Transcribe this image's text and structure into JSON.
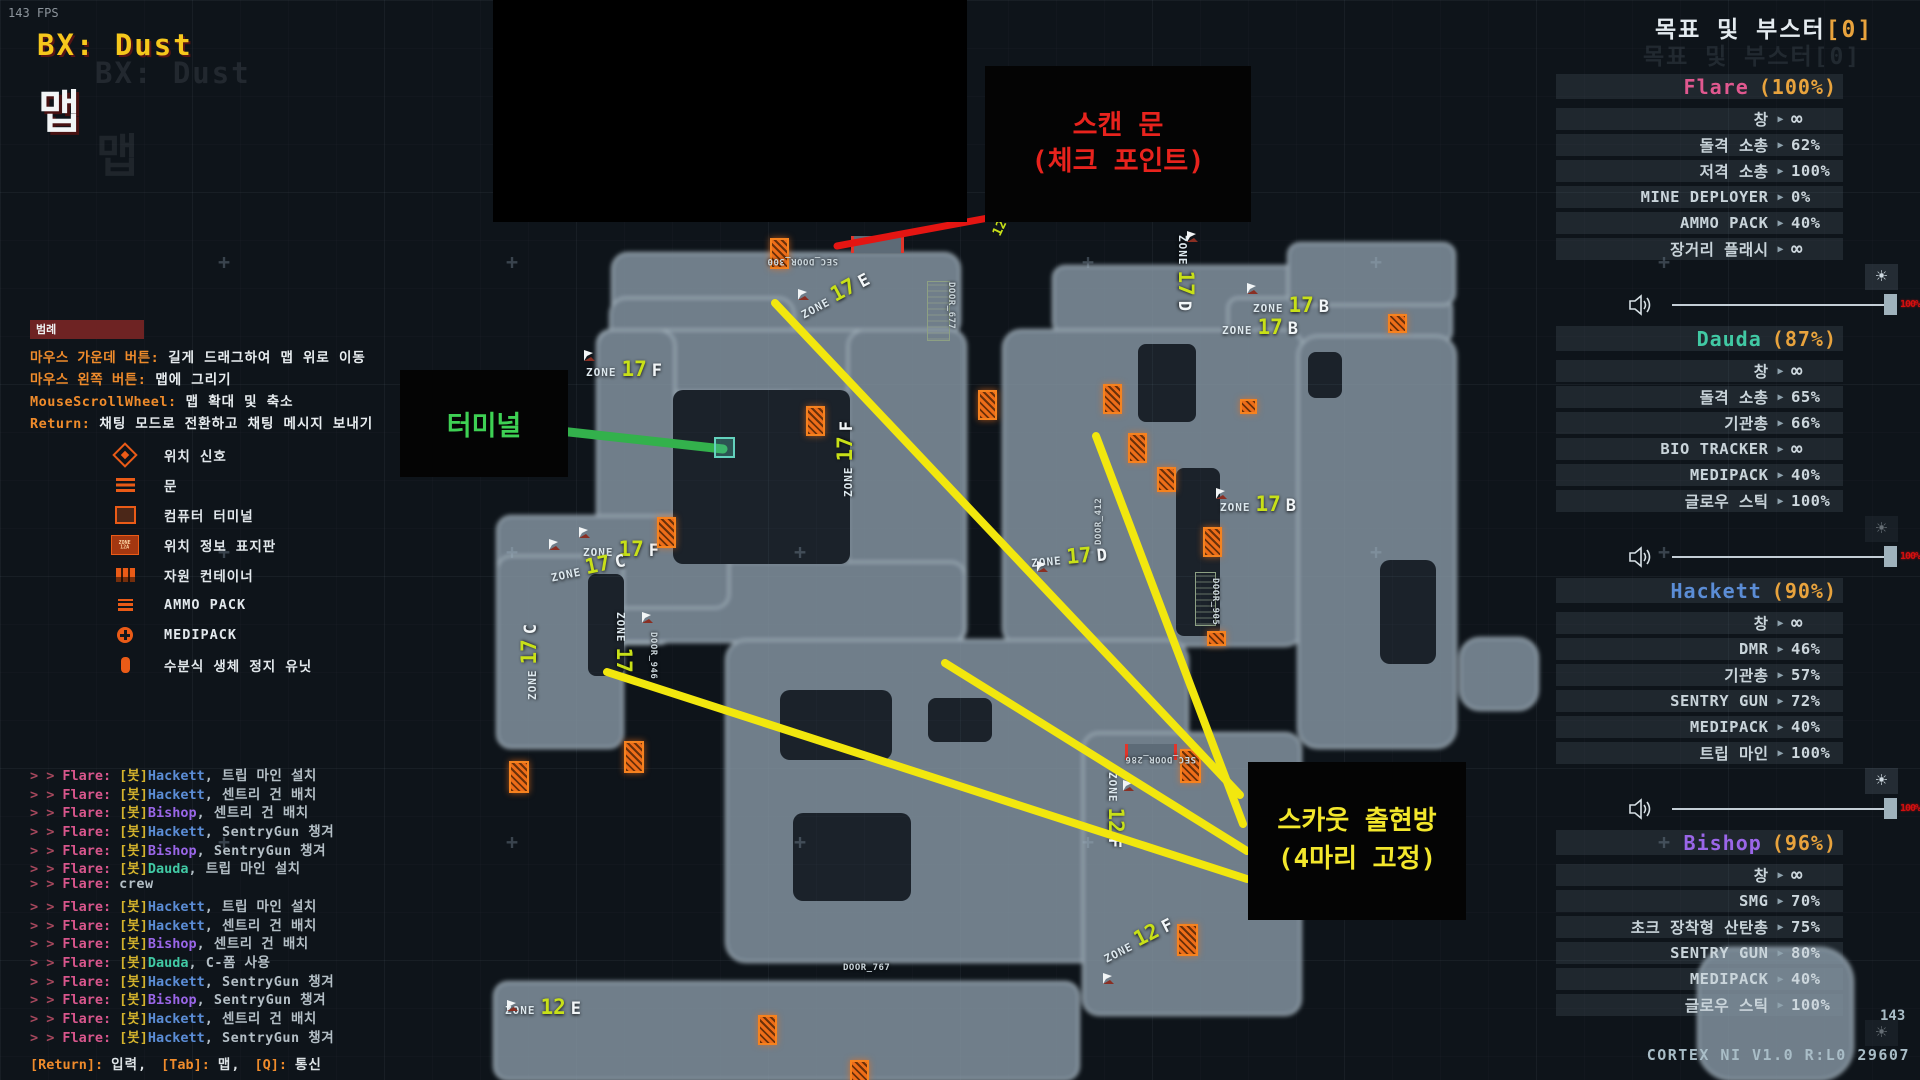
{
  "hud": {
    "fps": "143 FPS",
    "expedition": "BX: Dust",
    "map_label": "맵"
  },
  "objectives": {
    "title": "목표 및 부스터",
    "counter": "[0]"
  },
  "ui": {
    "arrow": "▶",
    "brightness": "☀",
    "volume_value": "100%",
    "infinity": "∞",
    "zone_word": "ZONE",
    "chat_prefix": "> >",
    "colors": {
      "accent_orange": "#e8a33d",
      "zone_number": "#c8e018",
      "door_orange": "#ee6d19",
      "line_yellow": "#f2e70e",
      "line_red": "#e41512",
      "line_green": "#33b14c"
    }
  },
  "players": [
    {
      "name": "Flare",
      "pct": "(100%)",
      "color": "#e0588f",
      "slider": true,
      "brightness_dim": false,
      "items": [
        {
          "label": "창",
          "value": "∞"
        },
        {
          "label": "돌격 소총",
          "value": "62%"
        },
        {
          "label": "저격 소총",
          "value": "100%"
        },
        {
          "label": "MINE DEPLOYER",
          "value": "0%"
        },
        {
          "label": "AMMO PACK",
          "value": "40%"
        },
        {
          "label": "장거리 플래시",
          "value": "∞"
        }
      ]
    },
    {
      "name": "Dauda",
      "pct": "(87%)",
      "color": "#41c9a4",
      "slider": true,
      "brightness_dim": true,
      "items": [
        {
          "label": "창",
          "value": "∞"
        },
        {
          "label": "돌격 소총",
          "value": "65%"
        },
        {
          "label": "기관총",
          "value": "66%"
        },
        {
          "label": "BIO TRACKER",
          "value": "∞"
        },
        {
          "label": "MEDIPACK",
          "value": "40%"
        },
        {
          "label": "글로우 스틱",
          "value": "100%"
        }
      ]
    },
    {
      "name": "Hackett",
      "pct": "(90%)",
      "color": "#5b8dd6",
      "slider": true,
      "brightness_dim": false,
      "items": [
        {
          "label": "창",
          "value": "∞"
        },
        {
          "label": "DMR",
          "value": "46%"
        },
        {
          "label": "기관총",
          "value": "57%"
        },
        {
          "label": "SENTRY GUN",
          "value": "72%"
        },
        {
          "label": "MEDIPACK",
          "value": "40%"
        },
        {
          "label": "트립 마인",
          "value": "100%"
        }
      ]
    },
    {
      "name": "Bishop",
      "pct": "(96%)",
      "color": "#9a66e8",
      "slider": false,
      "brightness_dim": true,
      "items": [
        {
          "label": "창",
          "value": "∞"
        },
        {
          "label": "SMG",
          "value": "70%"
        },
        {
          "label": "초크 장착형 산탄총",
          "value": "75%"
        },
        {
          "label": "SENTRY GUN",
          "value": "80%"
        },
        {
          "label": "MEDIPACK",
          "value": "40%"
        },
        {
          "label": "글로우 스틱",
          "value": "100%"
        }
      ]
    }
  ],
  "legend": {
    "title": "범례",
    "bindings": [
      {
        "key": "마우스 가운데 버튼:",
        "desc": "길게 드래그하여 맵 위로 이동"
      },
      {
        "key": "마우스 왼쪽 버튼:",
        "desc": "맵에 그리기"
      },
      {
        "key": "MouseScrollWheel:",
        "desc": "맵 확대 및 축소"
      },
      {
        "key": "Return:",
        "desc": "채팅 모드로 전환하고 채팅 메시지 보내기"
      }
    ],
    "items": [
      {
        "icon": "signal",
        "label": "위치 신호"
      },
      {
        "icon": "door",
        "label": "문"
      },
      {
        "icon": "terminal",
        "label": "컴퓨터 터미널"
      },
      {
        "icon": "zonesign",
        "label": "위치 정보 표지판",
        "sign_text": "ZONE\n12A"
      },
      {
        "icon": "container",
        "label": "자원 컨테이너"
      },
      {
        "icon": "ammo",
        "label": "AMMO PACK"
      },
      {
        "icon": "medi",
        "label": "MEDIPACK"
      },
      {
        "icon": "hsu",
        "label": "수분식 생체 정지 유닛"
      }
    ]
  },
  "chat": {
    "lines": [
      {
        "from": "Flare:",
        "bot": "[봇]",
        "who": "Hackett",
        "msg": ", 트립 마인 설치"
      },
      {
        "from": "Flare:",
        "bot": "[봇]",
        "who": "Hackett",
        "msg": ", 센트리 건 배치"
      },
      {
        "from": "Flare:",
        "bot": "[봇]",
        "who": "Bishop",
        "msg": ", 센트리 건 배치"
      },
      {
        "from": "Flare:",
        "bot": "[봇]",
        "who": "Hackett",
        "msg": ", SentryGun 챙겨"
      },
      {
        "from": "Flare:",
        "bot": "[봇]",
        "who": "Bishop",
        "msg": ", SentryGun 챙겨"
      },
      {
        "from": "Flare:",
        "bot": "[봇]",
        "who": "Dauda",
        "msg": ", 트립 마인 설치"
      },
      {
        "from": "Flare:",
        "bot": "",
        "who": "",
        "msg": "crew"
      },
      {
        "from": "Flare:",
        "bot": "[봇]",
        "who": "Hackett",
        "msg": ", 트립 마인 설치"
      },
      {
        "from": "Flare:",
        "bot": "[봇]",
        "who": "Hackett",
        "msg": ", 센트리 건 배치"
      },
      {
        "from": "Flare:",
        "bot": "[봇]",
        "who": "Bishop",
        "msg": ", 센트리 건 배치"
      },
      {
        "from": "Flare:",
        "bot": "[봇]",
        "who": "Dauda",
        "msg": ", C-폼 사용"
      },
      {
        "from": "Flare:",
        "bot": "[봇]",
        "who": "Hackett",
        "msg": ", SentryGun 챙겨"
      },
      {
        "from": "Flare:",
        "bot": "[봇]",
        "who": "Bishop",
        "msg": ", SentryGun 챙겨"
      },
      {
        "from": "Flare:",
        "bot": "[봇]",
        "who": "Hackett",
        "msg": ", 센트리 건 배치"
      },
      {
        "from": "Flare:",
        "bot": "[봇]",
        "who": "Hackett",
        "msg": ", SentryGun 챙겨"
      }
    ],
    "footer_segments": [
      {
        "key": "[Return]:",
        "text": "입력,"
      },
      {
        "key": "[Tab]:",
        "text": "맵,"
      },
      {
        "key": "[Q]:",
        "text": "통신"
      }
    ]
  },
  "map": {
    "zones": [
      {
        "z": "17E",
        "x": 795,
        "y": 302,
        "rot": -28
      },
      {
        "z": "17D",
        "x": 1198,
        "y": 235,
        "rot": 90
      },
      {
        "z": "17F",
        "x": 586,
        "y": 357,
        "rot": 0
      },
      {
        "z": "17F",
        "x": 833,
        "y": 497,
        "rot": -90
      },
      {
        "z": "17F",
        "x": 583,
        "y": 537,
        "rot": 0
      },
      {
        "z": "17C",
        "x": 548,
        "y": 563,
        "rot": -12
      },
      {
        "z": "17C",
        "x": 517,
        "y": 700,
        "rot": -90
      },
      {
        "z": "17",
        "x": 636,
        "y": 612,
        "rot": 90
      },
      {
        "z": "17D",
        "x": 1030,
        "y": 548,
        "rot": -5
      },
      {
        "z": "17B",
        "x": 1253,
        "y": 293,
        "rot": 0
      },
      {
        "z": "17B",
        "x": 1222,
        "y": 315,
        "rot": 0
      },
      {
        "z": "17B",
        "x": 1220,
        "y": 492,
        "rot": 0
      },
      {
        "z": "12F",
        "x": 1128,
        "y": 772,
        "rot": 90
      },
      {
        "z": "12F",
        "x": 1098,
        "y": 946,
        "rot": -27
      },
      {
        "z": "12E",
        "x": 505,
        "y": 995,
        "rot": 0
      }
    ],
    "door_labels": [
      {
        "text": "SEC_DOOR_300",
        "x": 838,
        "y": 266,
        "rot": 180
      },
      {
        "text": "DOOR_677",
        "x": 956,
        "y": 282,
        "rot": 90
      },
      {
        "text": "DOOR_412",
        "x": 1094,
        "y": 545,
        "rot": -90
      },
      {
        "text": "DOOR_905",
        "x": 1220,
        "y": 578,
        "rot": 90
      },
      {
        "text": "DOOR_946",
        "x": 658,
        "y": 632,
        "rot": 90
      },
      {
        "text": "SEC_DOOR_286",
        "x": 1196,
        "y": 764,
        "rot": 180
      },
      {
        "text": "DOOR_767",
        "x": 843,
        "y": 963,
        "rot": 0
      }
    ],
    "misc_labels": [
      {
        "text": "12",
        "x": 990,
        "y": 232,
        "rot": -64
      }
    ],
    "doors": [
      [
        770,
        238,
        15,
        27
      ],
      [
        806,
        406,
        15,
        26
      ],
      [
        978,
        390,
        15,
        26
      ],
      [
        1103,
        384,
        15,
        26
      ],
      [
        1128,
        433,
        15,
        26
      ],
      [
        1240,
        399,
        13,
        11
      ],
      [
        1388,
        314,
        15,
        15
      ],
      [
        1157,
        467,
        15,
        21
      ],
      [
        1203,
        527,
        15,
        26
      ],
      [
        1207,
        631,
        15,
        11
      ],
      [
        657,
        517,
        15,
        27
      ],
      [
        624,
        741,
        16,
        28
      ],
      [
        509,
        761,
        16,
        28
      ],
      [
        1180,
        749,
        17,
        30
      ],
      [
        1177,
        924,
        17,
        28
      ],
      [
        758,
        1015,
        15,
        26
      ],
      [
        850,
        1060,
        15,
        19
      ]
    ],
    "gates": [
      [
        927,
        281,
        21,
        58
      ],
      [
        1195,
        572,
        19,
        52
      ]
    ],
    "scan_doors": [
      [
        851,
        236,
        47,
        17
      ],
      [
        1125,
        744,
        46,
        16
      ]
    ],
    "flags": [
      [
        797,
        286
      ],
      [
        1186,
        228
      ],
      [
        583,
        347
      ],
      [
        578,
        524
      ],
      [
        548,
        536
      ],
      [
        641,
        609
      ],
      [
        1246,
        280
      ],
      [
        1215,
        485
      ],
      [
        1036,
        558
      ],
      [
        1122,
        777
      ],
      [
        1102,
        970
      ],
      [
        506,
        997
      ]
    ],
    "lines": [
      {
        "type": "red",
        "x1": 837,
        "y1": 246,
        "x2": 1053,
        "y2": 206
      },
      {
        "type": "green",
        "x1": 560,
        "y1": 431,
        "x2": 723,
        "y2": 449
      },
      {
        "type": "yellow",
        "x1": 775,
        "y1": 303,
        "x2": 1240,
        "y2": 795
      },
      {
        "type": "yellow",
        "x1": 1096,
        "y1": 436,
        "x2": 1243,
        "y2": 824
      },
      {
        "type": "yellow",
        "x1": 945,
        "y1": 663,
        "x2": 1247,
        "y2": 851
      },
      {
        "type": "yellow",
        "x1": 607,
        "y1": 672,
        "x2": 1247,
        "y2": 879
      }
    ],
    "annotations": {
      "scan_box": {
        "line1": "스캔 문",
        "line2": "(체크 포인트)"
      },
      "terminal_box": {
        "text": "터미널"
      },
      "scout_box": {
        "line1": "스카웃 출현방",
        "line2": "(4마리 고정)"
      }
    }
  },
  "footer": {
    "frame": "143",
    "version": "CORTEX NI V1.0 R:L0 29607"
  }
}
